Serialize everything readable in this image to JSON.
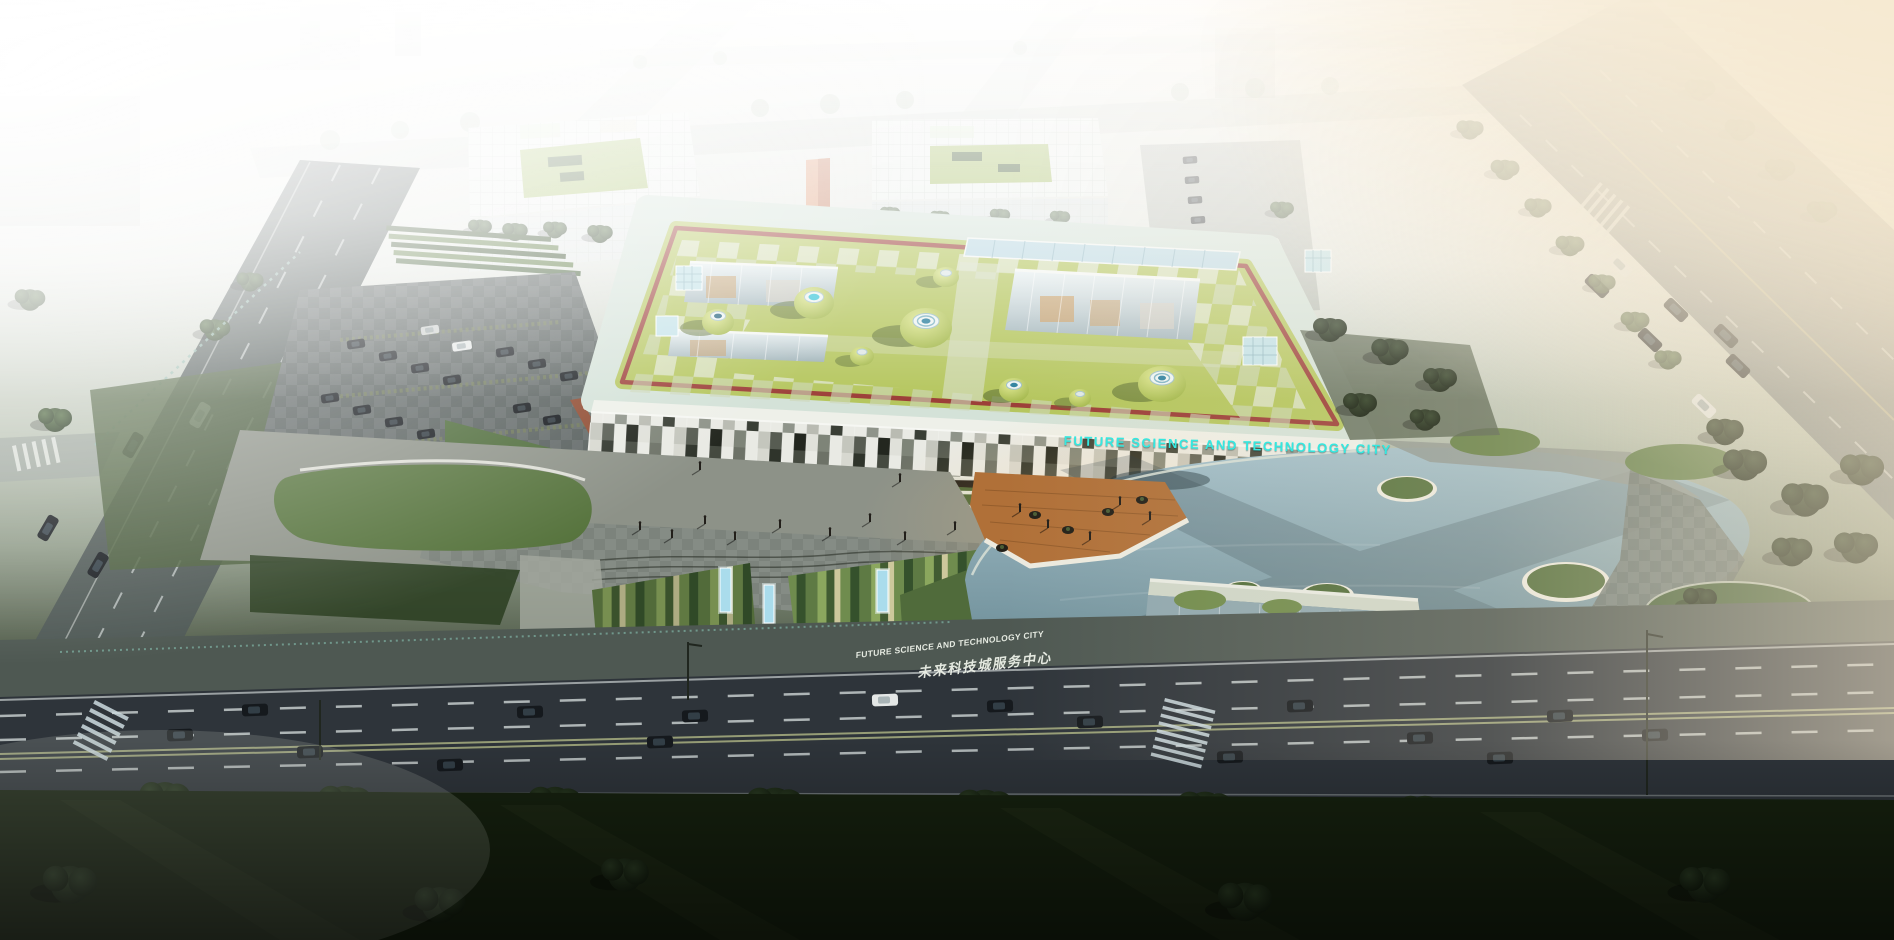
{
  "signs": {
    "facade_sign": "FUTURE SCIENCE AND TECHNOLOGY CITY",
    "lawn_sign_en": "FUTURE SCIENCE AND TECHNOLOGY CITY",
    "lawn_sign_zh": "未来科技城服务中心"
  },
  "palette": {
    "sign_cyan": "#35e8e0",
    "roof_green": "#b5c65e",
    "roof_trim_red": "#9c3f38",
    "roof_glass_band": "#cfe0d5",
    "water_blue": "#7fa3b2",
    "deck_wood": "#b07038",
    "asphalt_dark": "#2e343a",
    "haze_white": "#f1f1ed",
    "haze_warm": "#ecdcc0",
    "lawn_dark": "#16210f"
  }
}
